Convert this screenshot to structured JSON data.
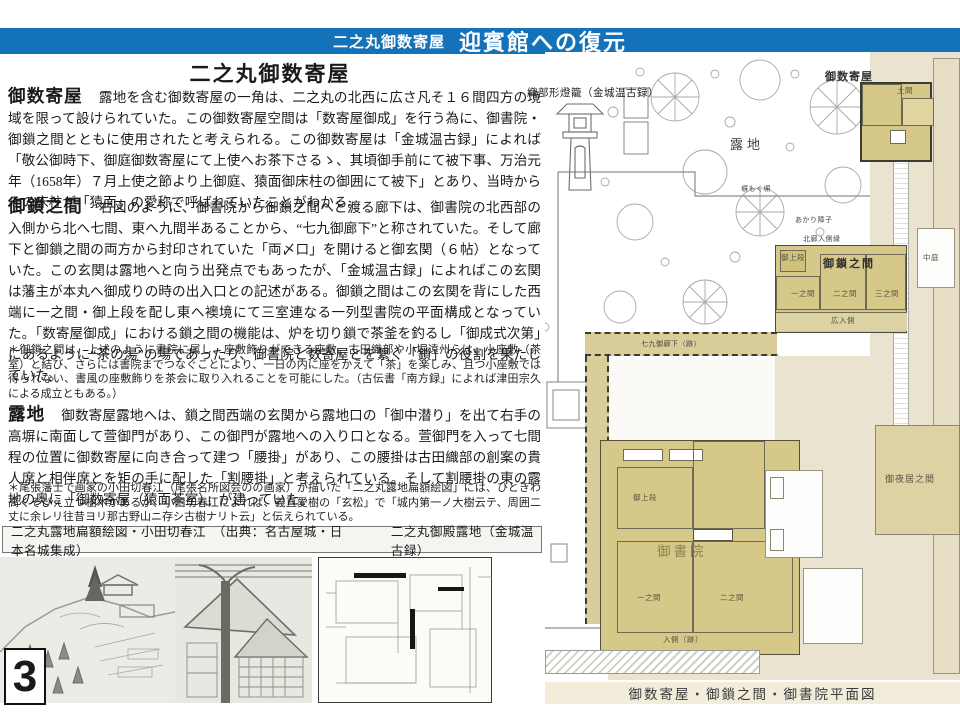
{
  "page": {
    "number": "3"
  },
  "header": {
    "title_small": "二之丸御数寄屋",
    "title_large": "迎賓館への復元",
    "bar_color": "#1472b8"
  },
  "main": {
    "heading": "二之丸御数寄屋",
    "sections": [
      {
        "label": "御数寄屋",
        "text": "露地を含む御数寄屋の一角は、二之丸の北西に広さ凡そ１６間四方の境域を限って設けられていた。この御数寄屋空間は「数寄屋御成」を行う為に、御書院・御鎖之間とともに使用されたと考えられる。この御数寄屋は「金城温古録」によれば「敬公御時下、御庭御数寄屋にて上使へお茶下さるゝ、其頃御手前にて被下事、万治元年（1658年）７月上使之節より上御庭、猿面御床柱の御囲にて被下」とあり、当時からその床柱が「猿面」の愛称で呼ばれていたことがわかる。"
      },
      {
        "label": "御鎖之間",
        "text": "右図のように、御書院から御鎖之間へと渡る廊下は、御書院の北西部の入側から北へ七間、東へ九間半あることから、“七九御廊下”と称されていた。そして廊下と御鎖之間の両方から封印されていた「両〆口」を開けると御玄関（６帖）となっていた。この玄関は露地へと向う出発点でもあったが、「金城温古録」によればこの玄関は藩主が本丸へ御成りの時の出入口との記述がある。御鎖之間はこの玄関を背にした西端に一之間・御上段を配し東へ襖境にて三室連なる一列型書院の平面構成となっていた。「数寄屋御成」における鎖之間の機能は、炉を切り鎖で茶釜を釣るし「御成式次第」にあるように“茶の湯”の場であったり、御書院と数寄屋とを繋ぐ「鎖」の役割を果たしていた。"
      },
      {
        "label": "露地",
        "text": "御数寄屋露地へは、鎖之間西端の玄関から露地口の「御中潜り」を出て右手の高塀に南面して萱御門があり、この御門が露地への入り口となる。萱御門を入って七間程の位置に御数寄屋に向き合って建つ「腰掛」があり、この腰掛は古田織部の創案の貴人席と相伴席とを矩の手に配した「割腰掛」と考えられている。そして割腰掛の東の露地の奥に「御数寄屋（猿面茶室）」が建っていた。"
      }
    ],
    "notes": [
      "＊御鎖之間は、上述のように書院に属し、座敷飾りができる座敷。古田織部や小堀遠州らは、小座敷（茶室）と結び、さらには書院までつなぐことにより、一日の内に座をかえて「茶」を楽しみ、且つ小座敷では得られない、書風の座敷飾りを茶会に取り入れることを可能にした。（古伝書「南方録」によれば津田宗久による成立ともある。）",
      "＊尾張藩士で画家の小田切春江（尾張名所図会のの画家）が描いた「二之丸露地扁額絵図」には、ひときわ高くそびえ立つ樹木があるが、小田切春江によれば、義直愛樹の「玄松」で「城内第一ノ大樹云テ、周囲二丈に余レリ往昔ヨリ那古野山ニ存シ古樹ナリト云」と伝えられている。"
    ],
    "captions": {
      "left": "二之丸露地扁額絵図・小田切春江　（出典：名古屋城・日本名城集成）",
      "right": "二之丸御殿露地（金城温古録）"
    }
  },
  "plan": {
    "lantern_label": "織部形燈籠（金城温古録）",
    "labels": {
      "garden": "露地",
      "sukiya": "御数寄屋",
      "kusari": "御鎖之間",
      "shoin": "御書院",
      "yoi": "御夜居之間",
      "corridor79": "七九御廊下（跡）",
      "naka_niwa": "中庭",
      "doma": "土間",
      "akari_shoji": "あかり障子",
      "hokuro": "北廊入側縁",
      "fence": "塀もく塀",
      "joudan_kusari": "御上段",
      "ichinoma_kusari": "一之間",
      "ninoma_kusari": "二之間",
      "sannoma_kusari": "三之間",
      "hirohairi": "広入側",
      "joudan_shoin": "御上段",
      "ichinoma_shoin": "一之間",
      "ninoma_shoin": "二之間",
      "irikawa": "入側（跡）"
    },
    "caption": "御数寄屋・御鎖之間・御書院平面図"
  },
  "colors": {
    "header_blue": "#1472b8",
    "tatami_tan": "#d6c888",
    "outer_beige": "#e9e3d0",
    "caption_strip": "#f2ecdb"
  }
}
